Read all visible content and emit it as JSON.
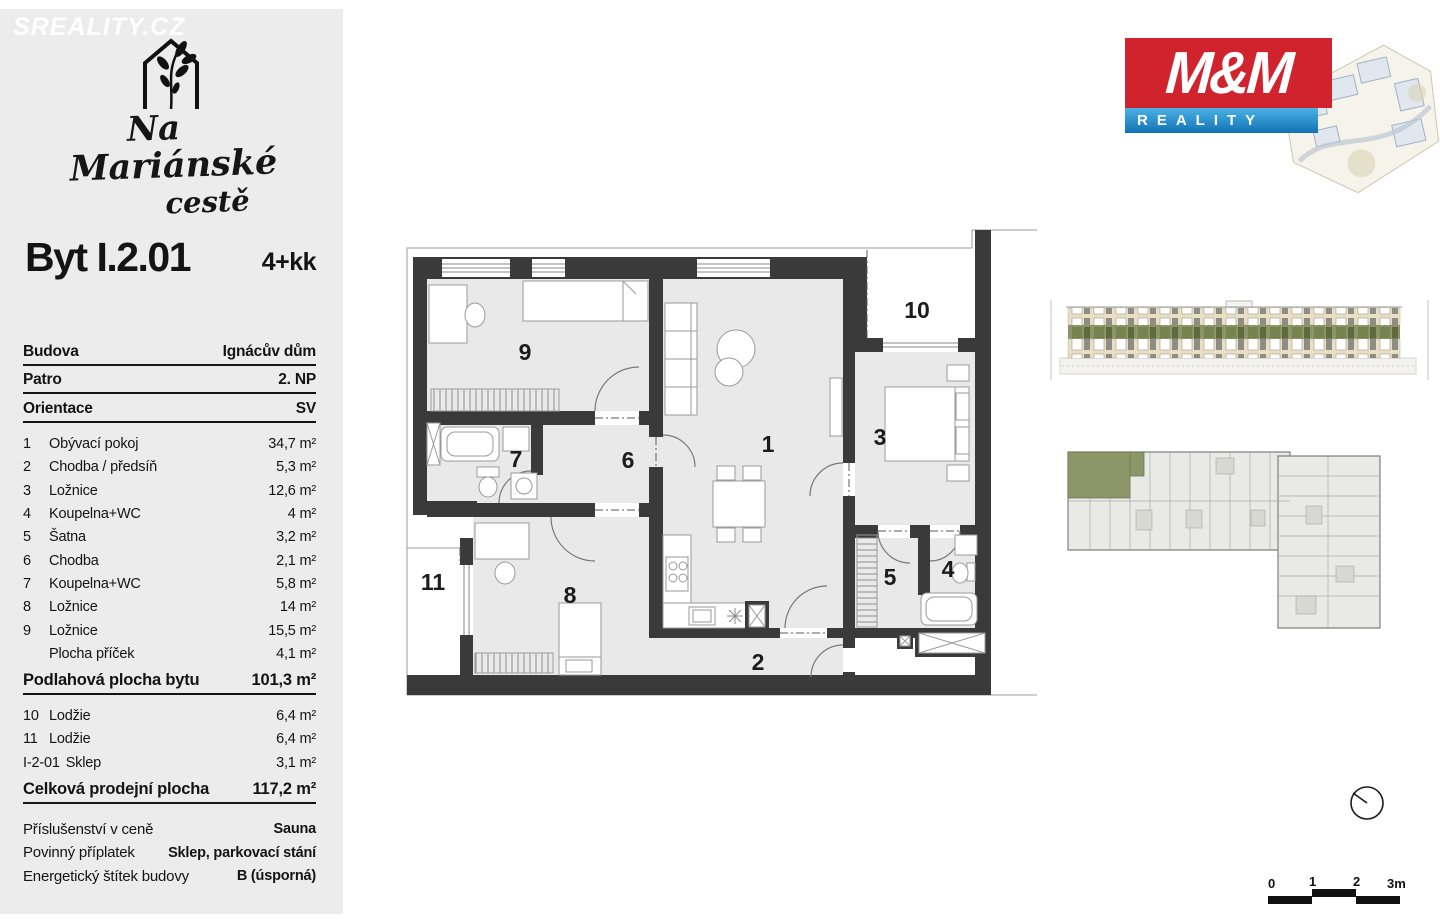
{
  "watermark": "SREALITY.CZ",
  "project": {
    "line1": "Na",
    "line2": "Mariánské",
    "line3": "cestě"
  },
  "unit": {
    "title": "Byt I.2.01",
    "layout": "4+kk"
  },
  "info": [
    {
      "label": "Budova",
      "value": "Ignácův dům"
    },
    {
      "label": "Patro",
      "value": "2. NP"
    },
    {
      "label": "Orientace",
      "value": "SV"
    }
  ],
  "rooms": [
    {
      "num": "1",
      "name": "Obývací pokoj",
      "area": "34,7 m²"
    },
    {
      "num": "2",
      "name": "Chodba / předsíň",
      "area": "5,3 m²"
    },
    {
      "num": "3",
      "name": "Ložnice",
      "area": "12,6 m²"
    },
    {
      "num": "4",
      "name": "Koupelna+WC",
      "area": "4 m²"
    },
    {
      "num": "5",
      "name": "Šatna",
      "area": "3,2 m²"
    },
    {
      "num": "6",
      "name": "Chodba",
      "area": "2,1 m²"
    },
    {
      "num": "7",
      "name": "Koupelna+WC",
      "area": "5,8 m²"
    },
    {
      "num": "8",
      "name": "Ložnice",
      "area": "14 m²"
    },
    {
      "num": "9",
      "name": "Ložnice",
      "area": "15,5 m²"
    },
    {
      "num": "",
      "name": "Plocha příček",
      "area": "4,1 m²"
    }
  ],
  "subtotal": {
    "label": "Podlahová plocha bytu",
    "value": "101,3 m²"
  },
  "extras": [
    {
      "num": "10",
      "name": "Lodžie",
      "area": "6,4 m²"
    },
    {
      "num": "11",
      "name": "Lodžie",
      "area": "6,4 m²"
    },
    {
      "num": "I-2-01",
      "name": "Sklep",
      "area": "3,1 m²"
    }
  ],
  "total": {
    "label": "Celková prodejní plocha",
    "value": "117,2 m²"
  },
  "details": [
    {
      "label": "Příslušenství v ceně",
      "value": "Sauna"
    },
    {
      "label": "Povinný příplatek",
      "value": "Sklep, parkovací stání"
    },
    {
      "label": "Energetický štítek budovy",
      "value": "B (úsporná)"
    }
  ],
  "brand": {
    "mm": "M&M",
    "reality": "REALITY"
  },
  "floorplan": {
    "labels": {
      "r1": "1",
      "r2": "2",
      "r3": "3",
      "r4": "4",
      "r5": "5",
      "r6": "6",
      "r7": "7",
      "r8": "8",
      "r9": "9",
      "r10": "10",
      "r11": "11"
    }
  },
  "scalebar": {
    "t0": "0",
    "t1": "1",
    "t2": "2",
    "t3": "3m"
  },
  "colors": {
    "accent_red": "#d1232e",
    "accent_blue": "#1272b4",
    "highlight_green": "#8c9565",
    "wall": "#3a3a3a"
  }
}
